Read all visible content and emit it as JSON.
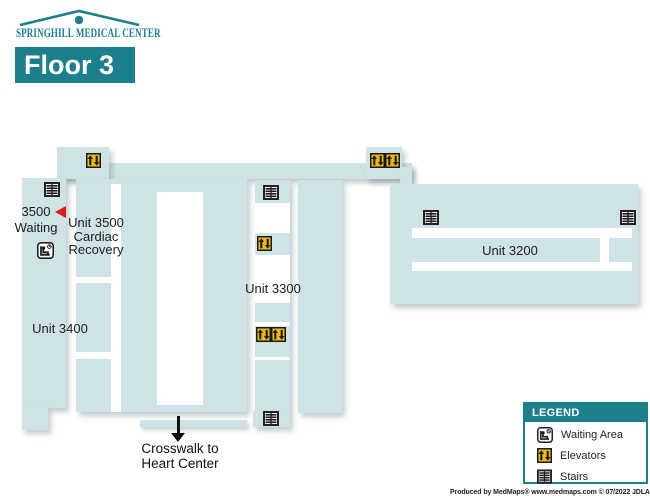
{
  "colors": {
    "teal": "#1d7e8c",
    "map_blue": "#cfe2e5",
    "elevator_yellow": "#edb71f",
    "marker_red": "#e0181f"
  },
  "header": {
    "logo_text": "SPRINGHILL MEDICAL CENTER",
    "floor_title": "Floor 3"
  },
  "map": {
    "units": {
      "unit3500": {
        "lines": [
          "Unit 3500",
          "Cardiac",
          "Recovery"
        ]
      },
      "unit3400": {
        "label": "Unit 3400"
      },
      "unit3300": {
        "label": "Unit 3300"
      },
      "unit3200": {
        "label": "Unit 3200"
      }
    },
    "waiting_area": {
      "lines": [
        "3500",
        "Waiting"
      ]
    },
    "crosswalk": {
      "lines": [
        "Crosswalk to",
        "Heart Center"
      ]
    }
  },
  "legend": {
    "title": "LEGEND",
    "items": [
      {
        "icon": "waiting-area-icon",
        "label": "Waiting Area"
      },
      {
        "icon": "elevators-icon",
        "label": "Elevators"
      },
      {
        "icon": "stairs-icon",
        "label": "Stairs"
      }
    ]
  },
  "footer": {
    "credit": "Produced by MedMaps®  www.medmaps.com  © 07/2022 JDLA, LLC"
  }
}
